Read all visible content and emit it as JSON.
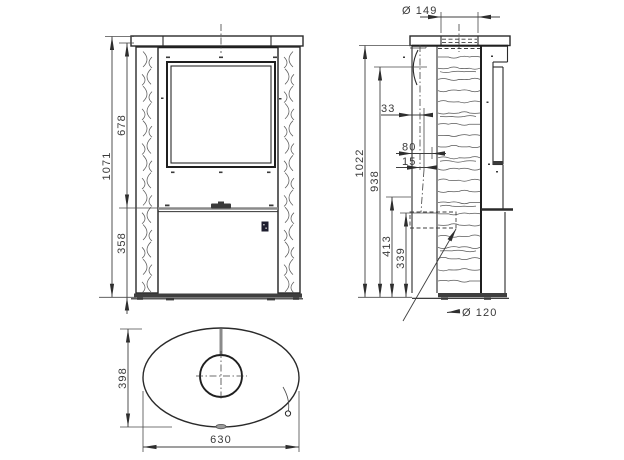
{
  "dimensions": {
    "front": {
      "overall_height": "1071",
      "upper_section_height": "678",
      "lower_section_height": "358"
    },
    "side": {
      "flue_diameter": "Ø 149",
      "body_height": "1022",
      "rear_flue_center_height": "938",
      "rear_flue_center_offset": "33",
      "offset_80": "80",
      "offset_15": "15",
      "air_inlet_top_height": "413",
      "air_inlet_height": "339",
      "air_inlet_diameter": "Ø 120"
    },
    "top": {
      "depth": "398",
      "width": "630"
    }
  },
  "colors": {
    "line": "#2a2a2a",
    "dimension": "#3f3f3f",
    "text": "#3a3a3a",
    "seam": "#8a8a8a",
    "background": "#ffffff"
  }
}
